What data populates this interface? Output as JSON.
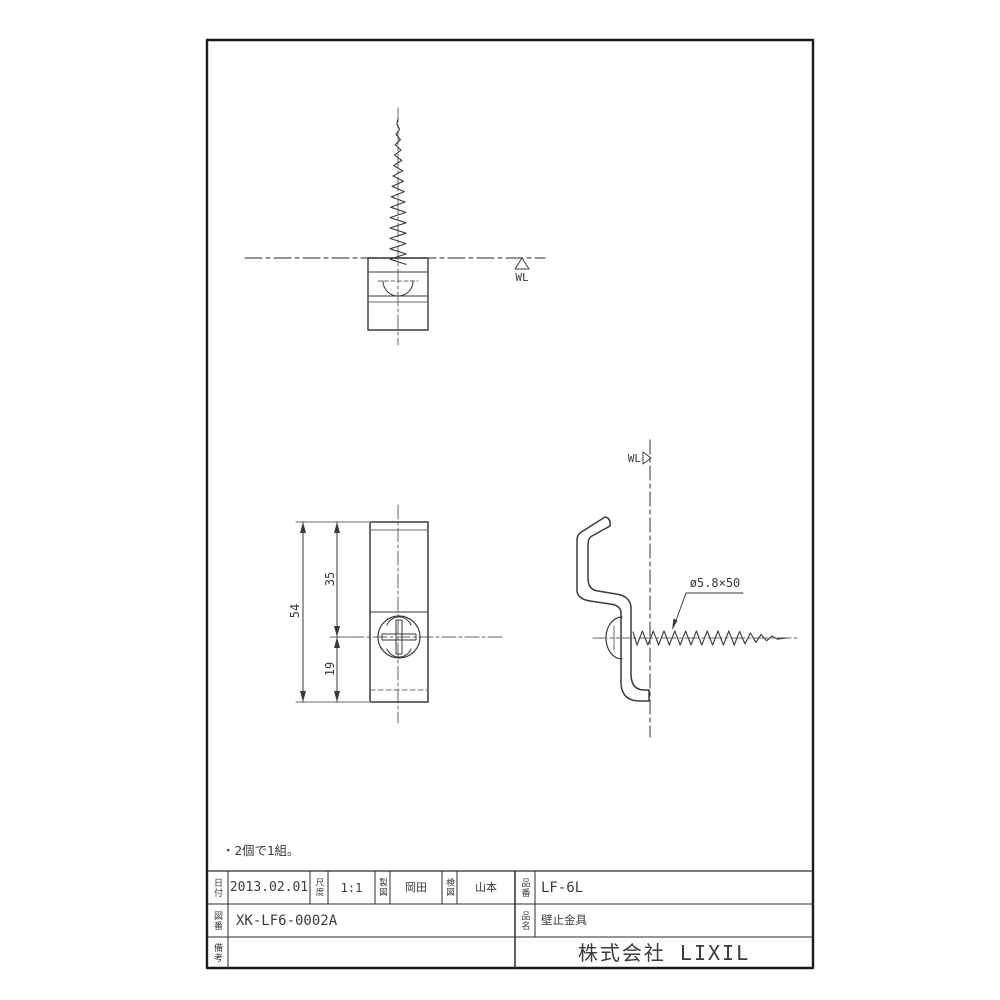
{
  "drawing": {
    "note": "・2個で1組。",
    "labels": {
      "wl_top": "WL",
      "wl_side": "WL",
      "screw_spec": "ø5.8×50"
    },
    "dimensions": {
      "overall_height": "54",
      "upper_span": "35",
      "lower_span": "19"
    }
  },
  "title_block": {
    "date_label": "日付",
    "date": "2013.02.01",
    "scale_label": "尺度",
    "scale": "1:1",
    "drafter_label": "製図",
    "drafter": "岡田",
    "checker_label": "検図",
    "checker": "山本",
    "part_no_label": "品番",
    "part_no": "LF-6L",
    "drawing_no_label": "図番",
    "drawing_no": "XK-LF6-0002A",
    "part_name_label": "品名",
    "part_name": "壁止金具",
    "remarks_label": "備考",
    "remarks": "",
    "company": "株式会社 LIXIL"
  },
  "colors": {
    "frame": "#1a1a1a",
    "line": "#3a3a3a",
    "thin_line": "#6a6a6a"
  }
}
